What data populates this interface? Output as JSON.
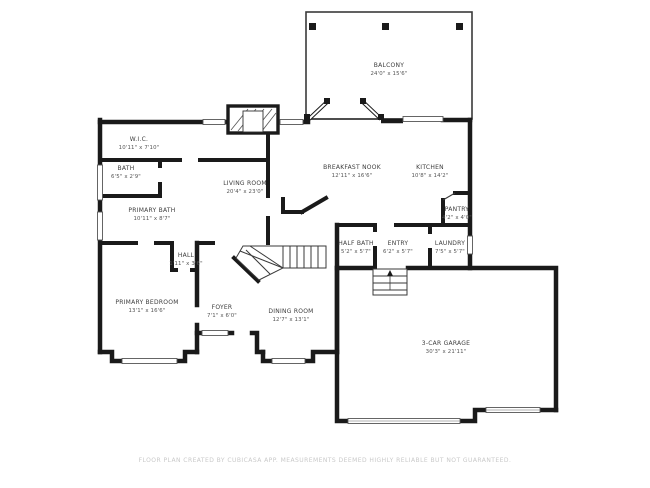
{
  "palette": {
    "background": "#ffffff",
    "wall_color": "#1a1a1a",
    "thin_line_color": "#3a3a3a",
    "label_color": "#3d3d3d",
    "footer_color": "#c9c9c9"
  },
  "rooms": {
    "balcony": {
      "name": "BALCONY",
      "dims": "24'0\" x 15'6\""
    },
    "wic": {
      "name": "W.I.C.",
      "dims": "10'11\" x 7'10\""
    },
    "bath": {
      "name": "BATH",
      "dims": "6'5\" x 2'9\""
    },
    "primary_bath": {
      "name": "PRIMARY BATH",
      "dims": "10'11\" x 8'7\""
    },
    "living_room": {
      "name": "LIVING ROOM",
      "dims": "20'4\" x 23'0\""
    },
    "breakfast_nook": {
      "name": "BREAKFAST NOOK",
      "dims": "12'11\" x 16'6\""
    },
    "kitchen": {
      "name": "KITCHEN",
      "dims": "10'8\" x 14'2\""
    },
    "pantry": {
      "name": "PANTRY",
      "dims": "4'2\" x 4'0\""
    },
    "half_bath": {
      "name": "HALF BATH",
      "dims": "5'2\" x 5'7\""
    },
    "entry": {
      "name": "ENTRY",
      "dims": "6'2\" x 5'7\""
    },
    "laundry": {
      "name": "LAUNDRY",
      "dims": "7'5\" x 5'7\""
    },
    "hall": {
      "name": "HALL",
      "dims": "1'11\" x 3'6\""
    },
    "foyer": {
      "name": "FOYER",
      "dims": "7'1\" x 6'0\""
    },
    "dining_room": {
      "name": "DINING ROOM",
      "dims": "12'7\" x 13'1\""
    },
    "primary_bedroom": {
      "name": "PRIMARY BEDROOM",
      "dims": "13'1\" x 16'6\""
    },
    "garage": {
      "name": "3-CAR GARAGE",
      "dims": "30'3\" x 21'11\""
    }
  },
  "footer": {
    "text": "FLOOR PLAN CREATED BY CUBICASA APP. MEASUREMENTS DEEMED HIGHLY RELIABLE BUT NOT GUARANTEED."
  }
}
